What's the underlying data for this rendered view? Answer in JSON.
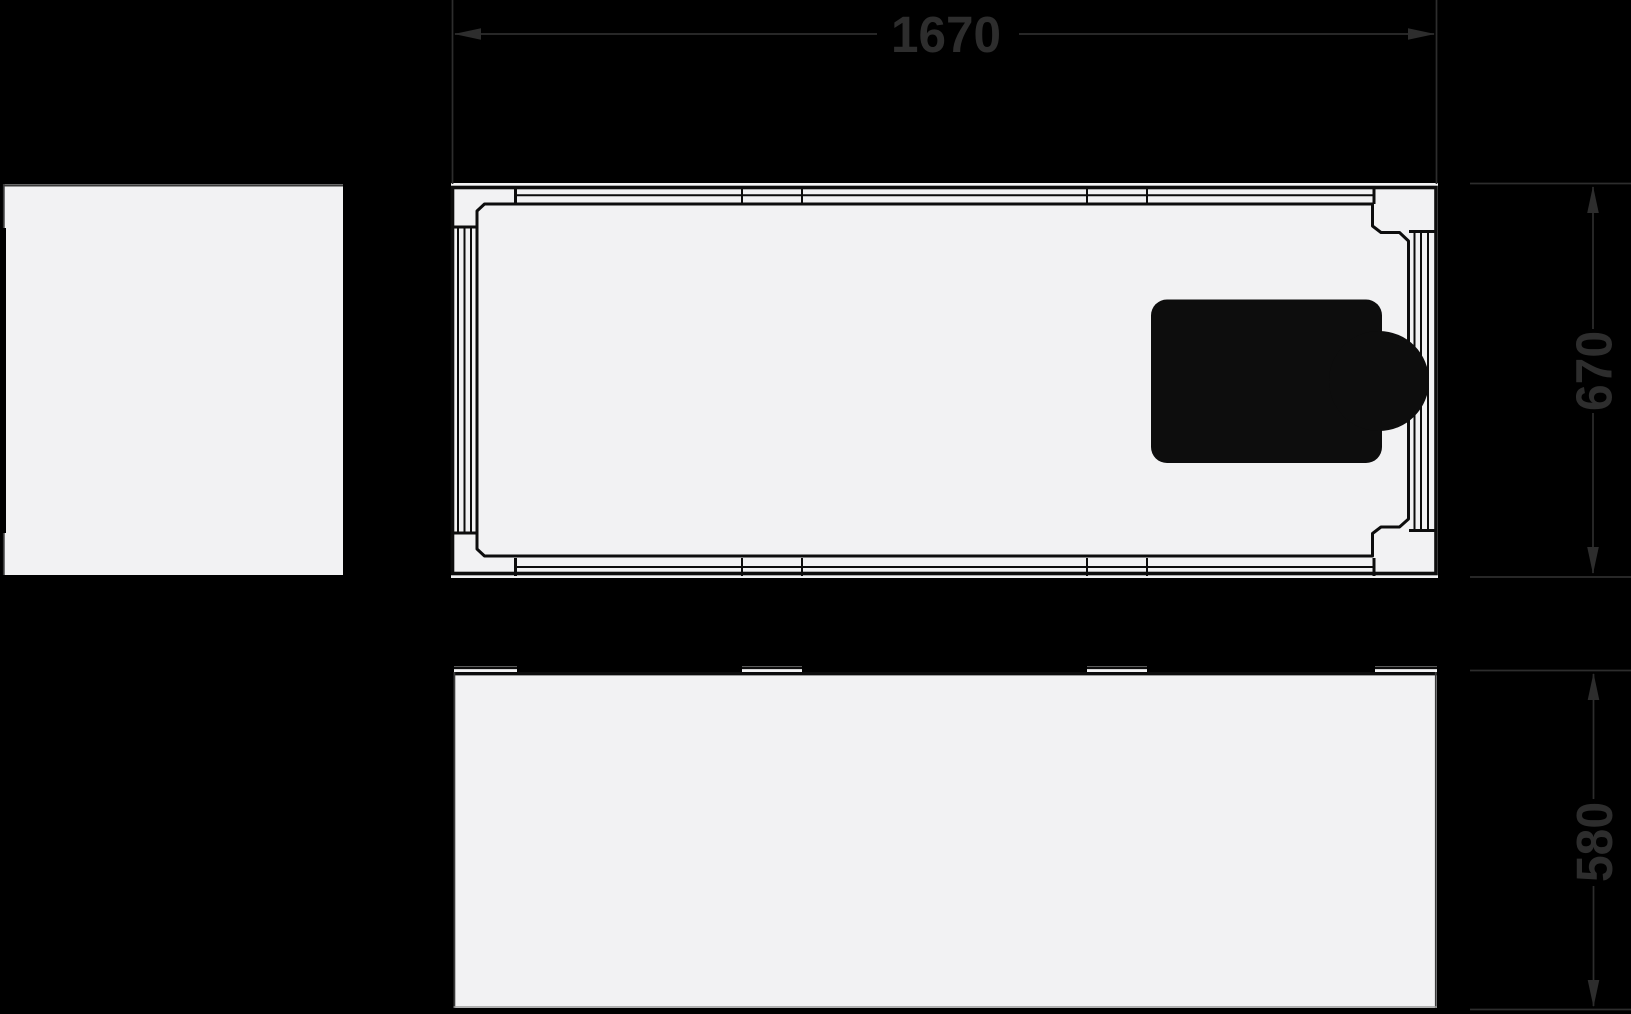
{
  "drawing": {
    "title": "bathtub-technical-drawing",
    "views": {
      "end_view": "end-elevation",
      "plan_view": "top-plan",
      "side_view": "side-elevation"
    }
  },
  "dimensions": {
    "width": "1670",
    "depth": "670",
    "height": "580"
  },
  "colors": {
    "background": "#000000",
    "surface": "#f2f2f3",
    "line": "#0d0d0d",
    "dimension": "#2d2d2d",
    "muted_line": "#9a9a9a",
    "soft_line": "#3a3a3a"
  }
}
